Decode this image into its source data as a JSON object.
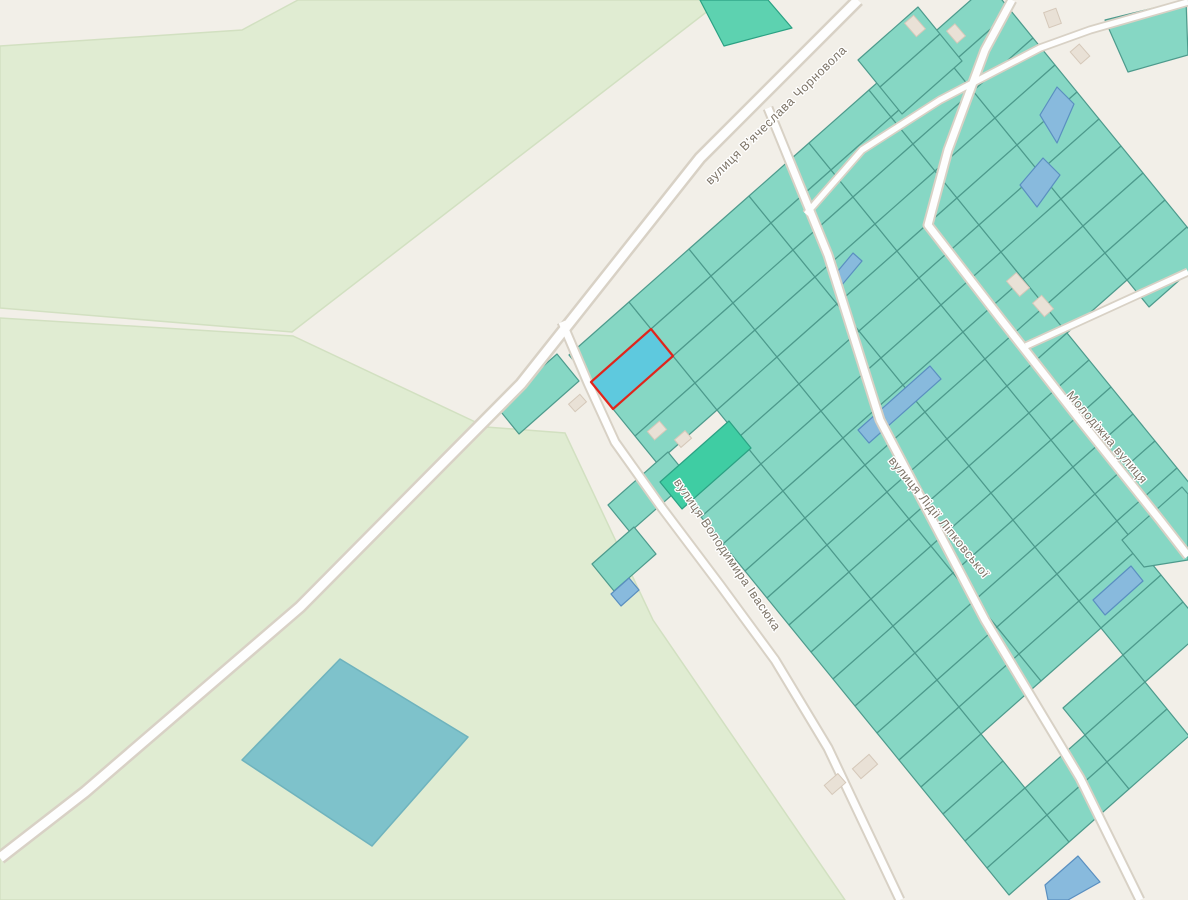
{
  "map": {
    "background": "#f2efe8",
    "colors": {
      "teal": "#86d7c4",
      "teal_stroke": "#4d9a8c",
      "medium": "#5dd2b0",
      "medium_stroke": "#2ba183",
      "dark": "#3fcda3",
      "dark_stroke": "#2ba183",
      "blue": "#88badd",
      "blue_stroke": "#5a8fc0",
      "selected_fill": "#5ec9de",
      "selected_stroke": "#e0251c",
      "field": "#e0ecd2",
      "field_stroke": "#d2e0c1",
      "pond": "#7ec2cb",
      "pond_stroke": "#6fb3bd",
      "road_casing": "#d8d1c5",
      "road_fill": "#fefefe",
      "building": "#e9e1d6",
      "building_stroke": "#d5c8b9",
      "label": "#7d7467"
    },
    "fields": [
      {
        "name": "field-northwest",
        "points": [
          [
            0,
            46
          ],
          [
            242,
            30
          ],
          [
            298,
            0
          ],
          [
            722,
            0
          ],
          [
            292,
            332
          ],
          [
            0,
            308
          ]
        ]
      },
      {
        "name": "field-southwest",
        "points": [
          [
            0,
            318
          ],
          [
            293,
            336
          ],
          [
            486,
            427
          ],
          [
            565,
            433
          ],
          [
            653,
            620
          ],
          [
            845,
            900
          ],
          [
            0,
            900
          ]
        ]
      }
    ],
    "pond": {
      "name": "pond",
      "points": [
        [
          340,
          659
        ],
        [
          468,
          737
        ],
        [
          372,
          846
        ],
        [
          242,
          760
        ]
      ]
    },
    "parcel_grid": {
      "origin": [
        569,
        355
      ],
      "a": [
        60,
        -53
      ],
      "b": [
        22,
        27
      ],
      "rows": [
        {
          "j": 0,
          "i_ranges": [
            [
              0,
              0
            ],
            [
              2,
              3
            ],
            [
              5,
              19
            ]
          ]
        },
        {
          "j": 1,
          "i_ranges": [
            [
              0,
              15
            ],
            [
              18,
              19
            ]
          ]
        },
        {
          "j": 2,
          "i_ranges": [
            [
              0,
              15
            ],
            [
              17,
              19
            ]
          ]
        },
        {
          "j": 3,
          "i_ranges": [
            [
              0,
              17
            ]
          ]
        },
        {
          "j": 4,
          "i_ranges": [
            [
              0,
              14
            ]
          ]
        },
        {
          "j": 5,
          "i_ranges": [
            [
              0,
              8
            ]
          ]
        },
        {
          "j": 6,
          "i_ranges": [
            [
              0,
              9
            ]
          ]
        }
      ]
    },
    "parcels_extra": [
      {
        "name": "parcel",
        "type": "teal",
        "points": [
          [
            497,
            407
          ],
          [
            557,
            354
          ],
          [
            579,
            381
          ],
          [
            519,
            434
          ]
        ]
      },
      {
        "name": "parcel",
        "type": "teal",
        "points": [
          [
            608,
            505
          ],
          [
            668,
            452
          ],
          [
            690,
            479
          ],
          [
            630,
            532
          ]
        ]
      },
      {
        "name": "parcel",
        "type": "teal",
        "points": [
          [
            592,
            564
          ],
          [
            634,
            527
          ],
          [
            656,
            554
          ],
          [
            614,
            591
          ]
        ]
      },
      {
        "name": "parcel",
        "type": "medium",
        "points": [
          [
            700,
            0
          ],
          [
            768,
            0
          ],
          [
            792,
            28
          ],
          [
            724,
            46
          ]
        ]
      },
      {
        "name": "parcel",
        "type": "teal",
        "points": [
          [
            858,
            60
          ],
          [
            918,
            7
          ],
          [
            940,
            34
          ],
          [
            880,
            87
          ]
        ]
      },
      {
        "name": "parcel",
        "type": "teal",
        "points": [
          [
            880,
            87
          ],
          [
            940,
            34
          ],
          [
            962,
            61
          ],
          [
            902,
            114
          ]
        ]
      },
      {
        "name": "parcel",
        "type": "teal",
        "points": [
          [
            1105,
            20
          ],
          [
            1186,
            0
          ],
          [
            1188,
            55
          ],
          [
            1128,
            72
          ]
        ]
      },
      {
        "name": "parcel",
        "type": "teal",
        "points": [
          [
            1122,
            540
          ],
          [
            1182,
            487
          ],
          [
            1188,
            494
          ],
          [
            1188,
            560
          ],
          [
            1144,
            567
          ]
        ]
      },
      {
        "name": "parcel-bright-green",
        "type": "dark",
        "points": [
          [
            660,
            482
          ],
          [
            729,
            421
          ],
          [
            751,
            448
          ],
          [
            682,
            509
          ]
        ]
      },
      {
        "name": "parcel-blue",
        "type": "blue",
        "points": [
          [
            1040,
            115
          ],
          [
            1057,
            87
          ],
          [
            1074,
            104
          ],
          [
            1057,
            143
          ]
        ]
      },
      {
        "name": "parcel-blue",
        "type": "blue",
        "points": [
          [
            1020,
            185
          ],
          [
            1043,
            158
          ],
          [
            1060,
            175
          ],
          [
            1037,
            207
          ]
        ]
      },
      {
        "name": "parcel-blue",
        "type": "blue",
        "points": [
          [
            858,
            430
          ],
          [
            930,
            366
          ],
          [
            941,
            379
          ],
          [
            869,
            443
          ]
        ]
      },
      {
        "name": "parcel-blue",
        "type": "blue",
        "points": [
          [
            611,
            594
          ],
          [
            629,
            578
          ],
          [
            639,
            590
          ],
          [
            621,
            606
          ]
        ]
      },
      {
        "name": "parcel-blue",
        "type": "blue",
        "points": [
          [
            1093,
            600
          ],
          [
            1131,
            566
          ],
          [
            1143,
            581
          ],
          [
            1105,
            615
          ]
        ]
      },
      {
        "name": "parcel-blue",
        "type": "blue",
        "points": [
          [
            1045,
            885
          ],
          [
            1078,
            856
          ],
          [
            1100,
            882
          ],
          [
            1068,
            900
          ],
          [
            1048,
            900
          ]
        ]
      },
      {
        "name": "parcel-blue",
        "type": "blue",
        "points": [
          [
            832,
            278
          ],
          [
            853,
            253
          ],
          [
            862,
            261
          ],
          [
            841,
            286
          ]
        ]
      }
    ],
    "selected_parcel": {
      "name": "selected-parcel",
      "points": [
        [
          591,
          382
        ],
        [
          651,
          329
        ],
        [
          673,
          356
        ],
        [
          613,
          409
        ]
      ]
    },
    "roads": [
      {
        "name": "road-chornovola",
        "points": [
          [
            858,
            0
          ],
          [
            700,
            158
          ],
          [
            521,
            384
          ],
          [
            300,
            607
          ],
          [
            85,
            792
          ],
          [
            0,
            858
          ]
        ],
        "casing": 14,
        "fill": 9
      },
      {
        "name": "road-ivasyuka",
        "points": [
          [
            562,
            322
          ],
          [
            588,
            383
          ],
          [
            615,
            442
          ],
          [
            662,
            508
          ],
          [
            720,
            585
          ],
          [
            775,
            660
          ],
          [
            828,
            748
          ],
          [
            900,
            900
          ]
        ],
        "casing": 11,
        "fill": 7
      },
      {
        "name": "road-lipkovskoi",
        "points": [
          [
            768,
            108
          ],
          [
            828,
            255
          ],
          [
            880,
            420
          ],
          [
            985,
            620
          ],
          [
            1080,
            778
          ],
          [
            1140,
            900
          ]
        ],
        "casing": 11,
        "fill": 7
      },
      {
        "name": "road-molodizhna",
        "points": [
          [
            1012,
            0
          ],
          [
            985,
            50
          ],
          [
            948,
            150
          ],
          [
            928,
            225
          ],
          [
            1000,
            318
          ],
          [
            1080,
            420
          ],
          [
            1160,
            520
          ],
          [
            1188,
            556
          ]
        ],
        "casing": 11,
        "fill": 7
      },
      {
        "name": "road-northeast-branch",
        "points": [
          [
            1188,
            2
          ],
          [
            1090,
            30
          ],
          [
            1040,
            48
          ],
          [
            940,
            100
          ],
          [
            862,
            150
          ],
          [
            806,
            214
          ]
        ],
        "casing": 9,
        "fill": 5.5
      },
      {
        "name": "road-connector",
        "points": [
          [
            1026,
            346
          ],
          [
            1188,
            272
          ]
        ],
        "casing": 9,
        "fill": 5.5
      }
    ],
    "street_labels": [
      {
        "name": "street-label-chornovola",
        "text": "вулиця В'ячеслава Чорновола",
        "x": 779,
        "y": 118,
        "rotate": -44.5
      },
      {
        "name": "street-label-ivasyuka",
        "text": "вулиця Володимира Івасюка",
        "x": 724,
        "y": 557,
        "rotate": 56
      },
      {
        "name": "street-label-lipkovskoi",
        "text": "вулиця Лідії Ліпковської",
        "x": 936,
        "y": 520,
        "rotate": 51
      },
      {
        "name": "street-label-molodizhna",
        "text": "Молодіжна вулиця",
        "x": 1104,
        "y": 440,
        "rotate": 49.5
      }
    ],
    "buildings": [
      {
        "x": 570,
        "y": 398,
        "w": 15,
        "h": 10,
        "rot": -41
      },
      {
        "x": 649,
        "y": 425,
        "w": 16,
        "h": 11,
        "rot": -41
      },
      {
        "x": 676,
        "y": 434,
        "w": 14,
        "h": 10,
        "rot": -41
      },
      {
        "x": 906,
        "y": 20,
        "w": 18,
        "h": 12,
        "rot": 49
      },
      {
        "x": 948,
        "y": 28,
        "w": 16,
        "h": 11,
        "rot": 49
      },
      {
        "x": 1046,
        "y": 10,
        "w": 13,
        "h": 16,
        "rot": -20
      },
      {
        "x": 1072,
        "y": 48,
        "w": 16,
        "h": 12,
        "rot": 49
      },
      {
        "x": 1008,
        "y": 278,
        "w": 20,
        "h": 13,
        "rot": 49
      },
      {
        "x": 1034,
        "y": 300,
        "w": 18,
        "h": 12,
        "rot": 49
      },
      {
        "x": 826,
        "y": 778,
        "w": 18,
        "h": 12,
        "rot": -41
      },
      {
        "x": 854,
        "y": 760,
        "w": 22,
        "h": 13,
        "rot": -41
      }
    ]
  }
}
